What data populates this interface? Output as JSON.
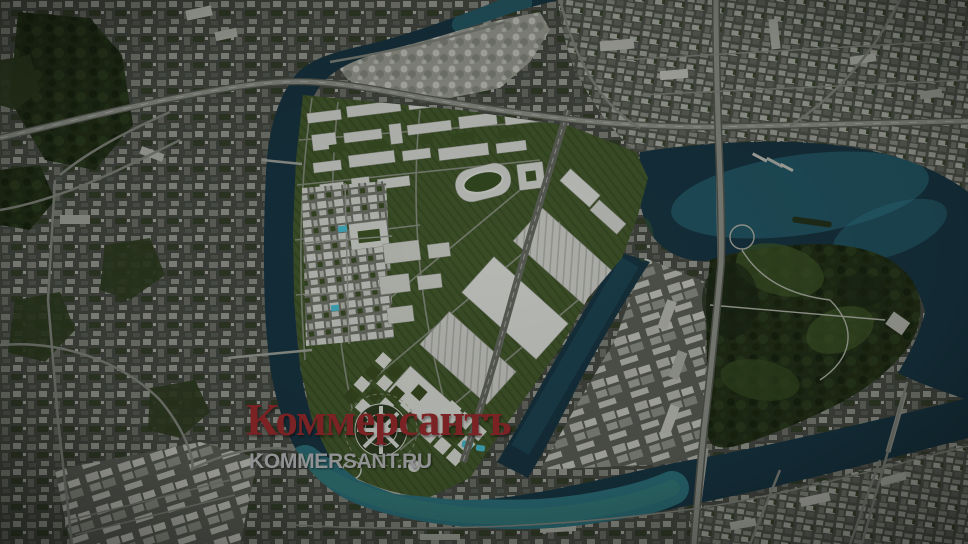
{
  "watermark": {
    "logo_text": "Коммерсантъ",
    "site_text": "KOMMERSANT.RU",
    "logo_color": "#7b2224",
    "site_color": "#909294"
  },
  "map": {
    "type": "satellite-aerial-with-masterplan-render",
    "colors": {
      "base": "#44473f",
      "water_dark": "#17333f",
      "water_mid": "#1e4c5a",
      "water_bright": "#2f7b85",
      "render_building": "#cfd0ca",
      "render_lawn": "#42572a",
      "park_green": "#2a3a1c",
      "forest": "#1f2b16",
      "road": "#84867e",
      "pool": "#45b7cc"
    }
  }
}
